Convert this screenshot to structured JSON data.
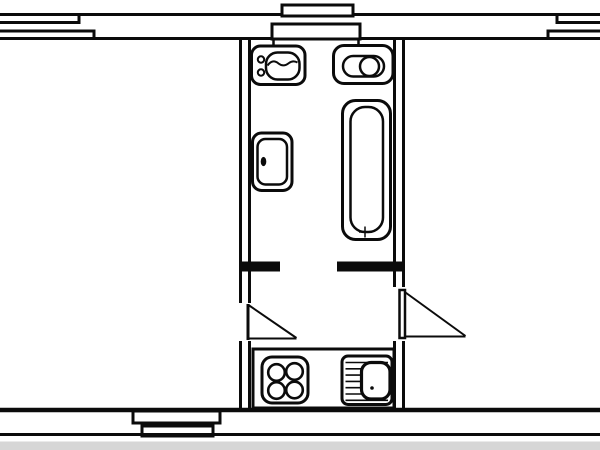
{
  "canvas": {
    "width": 600,
    "height": 450,
    "background": "#ffffff",
    "ink": "#0b0b0b",
    "photo_strip_color": "#d6d6d6"
  },
  "floorplan": {
    "elements": [
      {
        "name": "top-wall-outer-line",
        "type": "line",
        "x1": 0,
        "y1": 14.5,
        "x2": 600,
        "y2": 14.5,
        "w": 3
      },
      {
        "name": "top-wall-inner-line",
        "type": "line",
        "x1": 0,
        "y1": 38.5,
        "x2": 600,
        "y2": 38.5,
        "w": 3
      },
      {
        "name": "window-top-left-outer-pane",
        "type": "polyline",
        "points": [
          [
            0,
            22.5
          ],
          [
            79,
            22.5
          ],
          [
            79,
            15
          ]
        ],
        "w": 3
      },
      {
        "name": "window-top-left-inner-pane",
        "type": "polyline",
        "points": [
          [
            0,
            31
          ],
          [
            94,
            31
          ],
          [
            94,
            38
          ]
        ],
        "w": 3
      },
      {
        "name": "window-top-right-outer-pane",
        "type": "polyline",
        "points": [
          [
            600,
            22.5
          ],
          [
            557,
            22.5
          ],
          [
            557,
            15
          ]
        ],
        "w": 3
      },
      {
        "name": "window-top-right-inner-pane",
        "type": "polyline",
        "points": [
          [
            600,
            31
          ],
          [
            548,
            31
          ],
          [
            548,
            38
          ]
        ],
        "w": 3
      },
      {
        "name": "vent-block-upper",
        "type": "rect",
        "x": 282,
        "y": 5,
        "wd": 71,
        "ht": 11,
        "r": 0,
        "w": 3,
        "fill": "white"
      },
      {
        "name": "vent-block-lower",
        "type": "rect",
        "x": 272,
        "y": 24,
        "wd": 88,
        "ht": 15,
        "r": 0,
        "w": 3,
        "fill": "white"
      },
      {
        "name": "vent-block-tick-left",
        "type": "line",
        "x1": 273.5,
        "y1": 39,
        "x2": 273.5,
        "y2": 49,
        "w": 2.5
      },
      {
        "name": "vent-block-tick-right",
        "type": "line",
        "x1": 358.5,
        "y1": 39,
        "x2": 358.5,
        "y2": 49,
        "w": 2.5
      },
      {
        "name": "bottom-wall-inner-line",
        "type": "line",
        "x1": 0,
        "y1": 410,
        "x2": 600,
        "y2": 410,
        "w": 4.5
      },
      {
        "name": "window-bottom-outer-frame",
        "type": "rect",
        "x": 133,
        "y": 411,
        "wd": 87,
        "ht": 12,
        "r": 0,
        "w": 3,
        "fill": "white"
      },
      {
        "name": "window-bottom-inner-frame",
        "type": "rect",
        "x": 142,
        "y": 426,
        "wd": 71,
        "ht": 10,
        "r": 0,
        "w": 3,
        "fill": "white"
      },
      {
        "name": "bottom-wall-outer-line",
        "type": "line",
        "x1": 0,
        "y1": 434.5,
        "x2": 600,
        "y2": 434.5,
        "w": 3
      },
      {
        "name": "photo-bottom-strip",
        "type": "rect",
        "x": 0,
        "y": 441.5,
        "wd": 600,
        "ht": 9,
        "r": 0,
        "w": 0,
        "fill": "strip"
      },
      {
        "name": "hall-left-wall-outer-upper",
        "type": "line",
        "x1": 240.5,
        "y1": 38,
        "x2": 240.5,
        "y2": 303,
        "w": 3
      },
      {
        "name": "hall-left-wall-inner-upper",
        "type": "line",
        "x1": 249.5,
        "y1": 38,
        "x2": 249.5,
        "y2": 303,
        "w": 3
      },
      {
        "name": "hall-left-wall-outer-lower",
        "type": "line",
        "x1": 240.5,
        "y1": 341,
        "x2": 240.5,
        "y2": 410,
        "w": 3
      },
      {
        "name": "hall-left-wall-inner-lower",
        "type": "line",
        "x1": 249.5,
        "y1": 341,
        "x2": 249.5,
        "y2": 410,
        "w": 3
      },
      {
        "name": "hall-right-wall-outer-upper",
        "type": "line",
        "x1": 394.5,
        "y1": 38,
        "x2": 394.5,
        "y2": 287,
        "w": 3
      },
      {
        "name": "hall-right-wall-inner-upper",
        "type": "line",
        "x1": 403.5,
        "y1": 38,
        "x2": 403.5,
        "y2": 287,
        "w": 3
      },
      {
        "name": "hall-right-wall-outer-lower",
        "type": "line",
        "x1": 394.5,
        "y1": 341,
        "x2": 394.5,
        "y2": 410,
        "w": 3
      },
      {
        "name": "hall-right-wall-inner-lower",
        "type": "line",
        "x1": 403.5,
        "y1": 341,
        "x2": 403.5,
        "y2": 410,
        "w": 3
      },
      {
        "name": "bathroom-south-wall-left",
        "type": "line",
        "x1": 239,
        "y1": 266.5,
        "x2": 280,
        "y2": 266.5,
        "w": 10
      },
      {
        "name": "bathroom-south-wall-right",
        "type": "line",
        "x1": 337,
        "y1": 266.5,
        "x2": 405,
        "y2": 266.5,
        "w": 10
      },
      {
        "name": "left-room-door-leaf",
        "type": "line",
        "x1": 248,
        "y1": 304,
        "x2": 248,
        "y2": 340,
        "w": 3
      },
      {
        "name": "left-room-door-swing",
        "type": "line",
        "x1": 248.5,
        "y1": 305,
        "x2": 296.5,
        "y2": 338,
        "w": 2
      },
      {
        "name": "left-room-door-chord",
        "type": "line",
        "x1": 248.5,
        "y1": 338.5,
        "x2": 296.5,
        "y2": 338.5,
        "w": 2
      },
      {
        "name": "right-room-door-leaf",
        "type": "rect",
        "x": 399.5,
        "y": 290,
        "wd": 5.5,
        "ht": 48,
        "r": 0,
        "w": 2.5,
        "fill": "white"
      },
      {
        "name": "right-room-door-swing",
        "type": "line",
        "x1": 405.5,
        "y1": 292.5,
        "x2": 465.5,
        "y2": 336,
        "w": 2
      },
      {
        "name": "right-room-door-chord",
        "type": "line",
        "x1": 404,
        "y1": 336.5,
        "x2": 465.5,
        "y2": 336.5,
        "w": 2
      },
      {
        "name": "toilet-outline",
        "type": "rect",
        "x": 251.5,
        "y": 46,
        "wd": 53.5,
        "ht": 38.5,
        "r": 9,
        "w": 3,
        "fill": "white"
      },
      {
        "name": "toilet-button-top",
        "type": "circle",
        "cx": 261,
        "cy": 59.5,
        "r": 3.2,
        "w": 2,
        "fill": "none"
      },
      {
        "name": "toilet-button-bottom",
        "type": "circle",
        "cx": 261,
        "cy": 72.5,
        "r": 3.2,
        "w": 2,
        "fill": "none"
      },
      {
        "name": "toilet-bowl",
        "type": "rect",
        "x": 266,
        "y": 52.5,
        "wd": 33.5,
        "ht": 27,
        "r": 11.5,
        "w": 2.5,
        "fill": "none"
      },
      {
        "name": "toilet-water-line",
        "type": "path",
        "d": "M267.5,65.5 q5,-7 11,-2 q5,4 10.5,-0.5 q4,-3 8.5,-0.5",
        "w": 2
      },
      {
        "name": "washbasin-top-outline",
        "type": "rect",
        "x": 333.5,
        "y": 45.5,
        "wd": 59.5,
        "ht": 38,
        "r": 10.5,
        "w": 3,
        "fill": "white"
      },
      {
        "name": "washbasin-top-rim",
        "type": "rect",
        "x": 343,
        "y": 56,
        "wd": 41,
        "ht": 20.5,
        "r": 10.2,
        "w": 2.5,
        "fill": "none"
      },
      {
        "name": "washbasin-top-bowl",
        "type": "circle",
        "cx": 369.5,
        "cy": 66.5,
        "r": 9.5,
        "w": 2.5,
        "fill": "white"
      },
      {
        "name": "washbasin-left-outline",
        "type": "rect",
        "x": 252.5,
        "y": 133,
        "wd": 39.5,
        "ht": 57.5,
        "r": 9,
        "w": 3,
        "fill": "white"
      },
      {
        "name": "washbasin-left-bowl",
        "type": "rect",
        "x": 257.5,
        "y": 139,
        "wd": 29.5,
        "ht": 45.5,
        "r": 8,
        "w": 2.5,
        "fill": "none"
      },
      {
        "name": "washbasin-left-faucet",
        "type": "ellipse",
        "cx": 263.5,
        "cy": 161.5,
        "rx": 2.8,
        "ry": 4.6,
        "w": 0,
        "fill": "ink"
      },
      {
        "name": "bathtub-outline",
        "type": "rect",
        "x": 342.5,
        "y": 100.5,
        "wd": 48,
        "ht": 139,
        "r": 13,
        "w": 3,
        "fill": "white"
      },
      {
        "name": "bathtub-inner",
        "type": "rect",
        "x": 350.5,
        "y": 107,
        "wd": 32.5,
        "ht": 125,
        "r": 14.5,
        "w": 2.5,
        "fill": "none"
      },
      {
        "name": "bathtub-drain-horizontal",
        "type": "line",
        "x1": 359,
        "y1": 232,
        "x2": 371,
        "y2": 232,
        "w": 1.5
      },
      {
        "name": "bathtub-drain-vertical",
        "type": "line",
        "x1": 365,
        "y1": 226.5,
        "x2": 365,
        "y2": 237.5,
        "w": 1.5
      },
      {
        "name": "kitchen-counter",
        "type": "rect",
        "x": 253,
        "y": 349,
        "wd": 141,
        "ht": 59,
        "r": 0,
        "w": 3,
        "fill": "white"
      },
      {
        "name": "stove-outline",
        "type": "rect",
        "x": 262,
        "y": 357,
        "wd": 46,
        "ht": 46,
        "r": 10,
        "w": 3,
        "fill": "none"
      },
      {
        "name": "stove-burner-top-left",
        "type": "circle",
        "cx": 276.5,
        "cy": 372.5,
        "r": 8.3,
        "w": 2.6,
        "fill": "none"
      },
      {
        "name": "stove-burner-top-right",
        "type": "circle",
        "cx": 294.5,
        "cy": 371.5,
        "r": 8.3,
        "w": 2.6,
        "fill": "none"
      },
      {
        "name": "stove-burner-bottom-left",
        "type": "circle",
        "cx": 276.5,
        "cy": 390.5,
        "r": 8.3,
        "w": 2.6,
        "fill": "none"
      },
      {
        "name": "stove-burner-bottom-right",
        "type": "circle",
        "cx": 294.5,
        "cy": 390,
        "r": 8.3,
        "w": 2.6,
        "fill": "none"
      },
      {
        "name": "kitchen-sink-unit",
        "type": "rect",
        "x": 342,
        "y": 356,
        "wd": 50,
        "ht": 48.5,
        "r": 6,
        "w": 3,
        "fill": "none"
      },
      {
        "name": "kitchen-sink-drainboard-line-1",
        "type": "line",
        "x1": 345.5,
        "y1": 362.5,
        "x2": 388,
        "y2": 362.5,
        "w": 1.6
      },
      {
        "name": "kitchen-sink-drainboard-line-2",
        "type": "line",
        "x1": 345.5,
        "y1": 368.8,
        "x2": 388,
        "y2": 368.8,
        "w": 1.6
      },
      {
        "name": "kitchen-sink-drainboard-line-3",
        "type": "line",
        "x1": 345.5,
        "y1": 375.1,
        "x2": 388,
        "y2": 375.1,
        "w": 1.6
      },
      {
        "name": "kitchen-sink-drainboard-line-4",
        "type": "line",
        "x1": 345.5,
        "y1": 381.4,
        "x2": 388,
        "y2": 381.4,
        "w": 1.6
      },
      {
        "name": "kitchen-sink-drainboard-line-5",
        "type": "line",
        "x1": 345.5,
        "y1": 387.7,
        "x2": 388,
        "y2": 387.7,
        "w": 1.6
      },
      {
        "name": "kitchen-sink-drainboard-line-6",
        "type": "line",
        "x1": 345.5,
        "y1": 394,
        "x2": 388,
        "y2": 394,
        "w": 1.6
      },
      {
        "name": "kitchen-sink-drainboard-line-7",
        "type": "line",
        "x1": 345.5,
        "y1": 400.3,
        "x2": 388,
        "y2": 400.3,
        "w": 1.6
      },
      {
        "name": "kitchen-sink-basin",
        "type": "rect",
        "x": 361.5,
        "y": 362.5,
        "wd": 28.5,
        "ht": 36.5,
        "r": 9.5,
        "w": 3.2,
        "fill": "white"
      },
      {
        "name": "kitchen-sink-drain-dot",
        "type": "circle",
        "cx": 372,
        "cy": 388,
        "r": 1.8,
        "w": 0,
        "fill": "ink"
      }
    ]
  }
}
